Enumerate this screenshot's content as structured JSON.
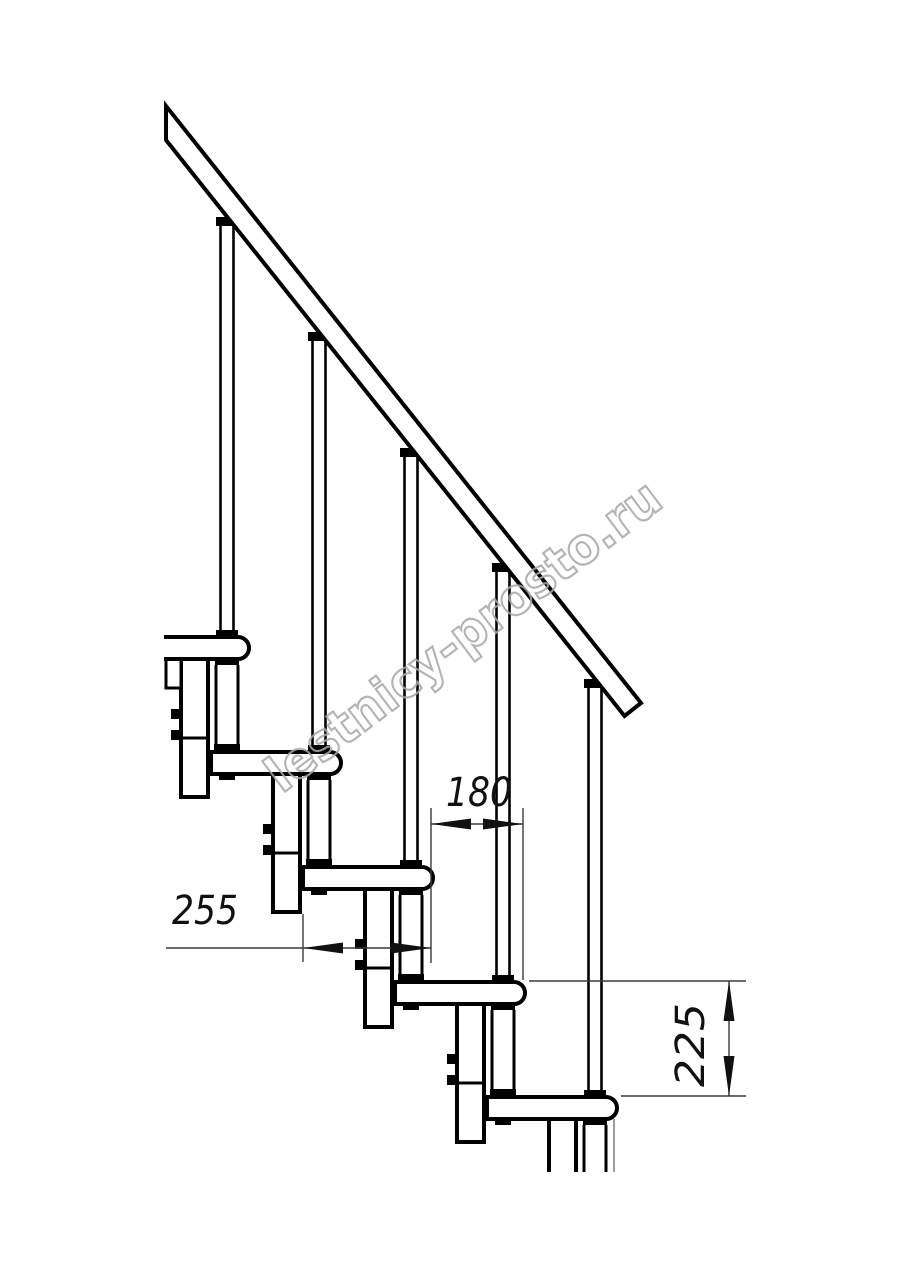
{
  "drawing": {
    "dimensions": {
      "run_mm": "180",
      "tread_depth_mm": "255",
      "rise_mm": "225"
    },
    "watermark": "lestnicy-prosto.ru",
    "colors": {
      "line": "#000000",
      "dimension_line": "#3a3a3a",
      "watermark": "#a8a8a8",
      "background": "#ffffff"
    }
  }
}
